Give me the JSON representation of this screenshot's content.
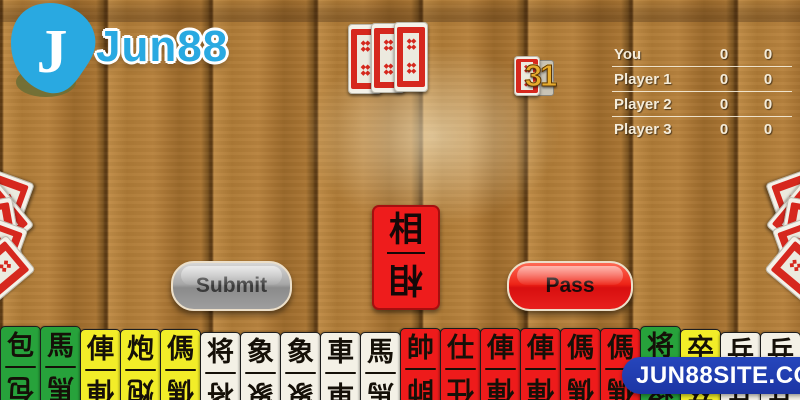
{
  "brand": {
    "name": "Jun88"
  },
  "watermark": {
    "text": "JUN88SITE.COM"
  },
  "scoreboard": {
    "rows": [
      {
        "name": "You",
        "cols": [
          "0",
          "0"
        ]
      },
      {
        "name": "Player 1",
        "cols": [
          "0",
          "0"
        ]
      },
      {
        "name": "Player 2",
        "cols": [
          "0",
          "0"
        ]
      },
      {
        "name": "Player 3",
        "cols": [
          "0",
          "0"
        ]
      }
    ]
  },
  "deck": {
    "remaining": "31"
  },
  "table": {
    "facedown_count": 3,
    "played_card": {
      "char": "相",
      "color": "red"
    }
  },
  "opponents": {
    "left_fan_count": 5,
    "right_fan_count": 5
  },
  "actions": {
    "submit": "Submit",
    "pass": "Pass"
  },
  "hand": {
    "cards": [
      {
        "char": "包",
        "color": "green"
      },
      {
        "char": "馬",
        "color": "green"
      },
      {
        "char": "俥",
        "color": "yellow"
      },
      {
        "char": "炮",
        "color": "yellow"
      },
      {
        "char": "傌",
        "color": "yellow"
      },
      {
        "char": "将",
        "color": "white"
      },
      {
        "char": "象",
        "color": "white"
      },
      {
        "char": "象",
        "color": "white"
      },
      {
        "char": "車",
        "color": "white"
      },
      {
        "char": "馬",
        "color": "white"
      },
      {
        "char": "帥",
        "color": "red"
      },
      {
        "char": "仕",
        "color": "red"
      },
      {
        "char": "俥",
        "color": "red"
      },
      {
        "char": "俥",
        "color": "red"
      },
      {
        "char": "傌",
        "color": "red"
      },
      {
        "char": "傌",
        "color": "red"
      },
      {
        "char": "将",
        "color": "green"
      },
      {
        "char": "卒",
        "color": "yellow"
      },
      {
        "char": "兵",
        "color": "white"
      },
      {
        "char": "兵",
        "color": "white"
      }
    ]
  },
  "card_back": {
    "diamond_glyph": "◆◆\n◆◆"
  },
  "colors": {
    "accent_blue": "#29a9e1",
    "watermark_navy": "#1c35a4",
    "card_red": "#ee1b1b",
    "card_green": "#27a23b",
    "card_yellow": "#f2ed28",
    "card_white": "#f4f1e6",
    "button_gray": "#9e9e9e",
    "button_red": "#e8201d",
    "deck_count_gold": "#e7ac2d"
  }
}
